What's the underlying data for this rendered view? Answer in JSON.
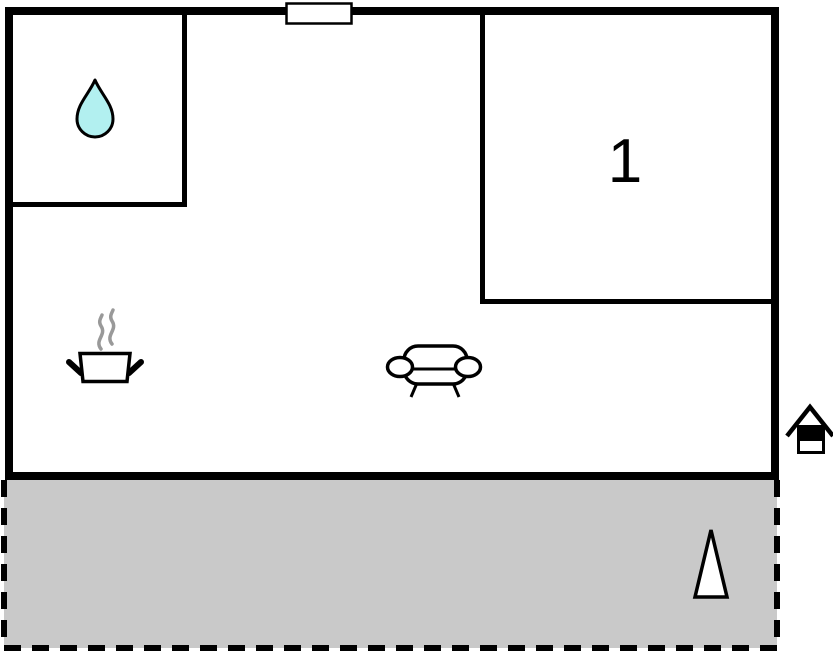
{
  "plan": {
    "rooms": {
      "room1": {
        "label": "1"
      }
    },
    "icons": {
      "window": "window-marker",
      "water_drop": "water-drop-icon",
      "steam": "steam-icon",
      "cooking_pot": "cooking-pot-icon",
      "sofa": "sofa-icon",
      "entrance": "house-entrance-icon",
      "tree": "tree-icon"
    },
    "colors": {
      "wall": "#000000",
      "background": "#ffffff",
      "water_drop_fill": "#b2f0f0",
      "terrace_fill": "#c9c9c9",
      "steam_stroke": "#999999"
    }
  }
}
